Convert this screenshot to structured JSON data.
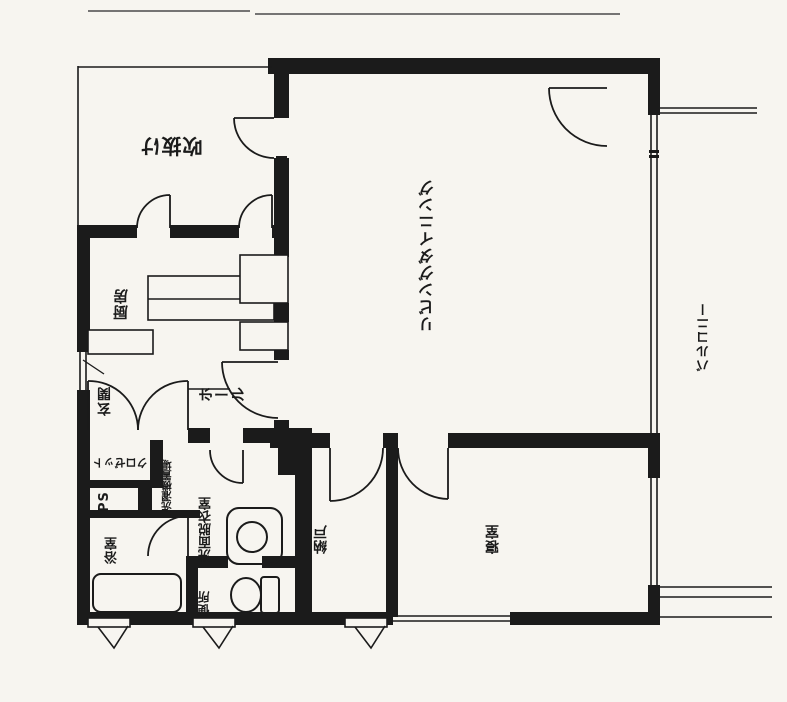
{
  "plan": {
    "type": "floor-plan-scan",
    "labels": {
      "void": "吹抜け",
      "living_dining": "リビングダイニング",
      "balcony": "バルコニー",
      "kitchen": "厨房",
      "entrance": "玄関",
      "hall": "ホール",
      "closet": "クロゼット",
      "pipe_space": "PS",
      "laundry": "洗濯機置場",
      "washroom": "洗面脱衣室",
      "bathroom": "浴室",
      "toilet": "便所",
      "storage": "納戸",
      "bedroom": "寝室"
    },
    "colors": {
      "line": "#1b1b1b",
      "paper": "#f7f5f0"
    }
  }
}
